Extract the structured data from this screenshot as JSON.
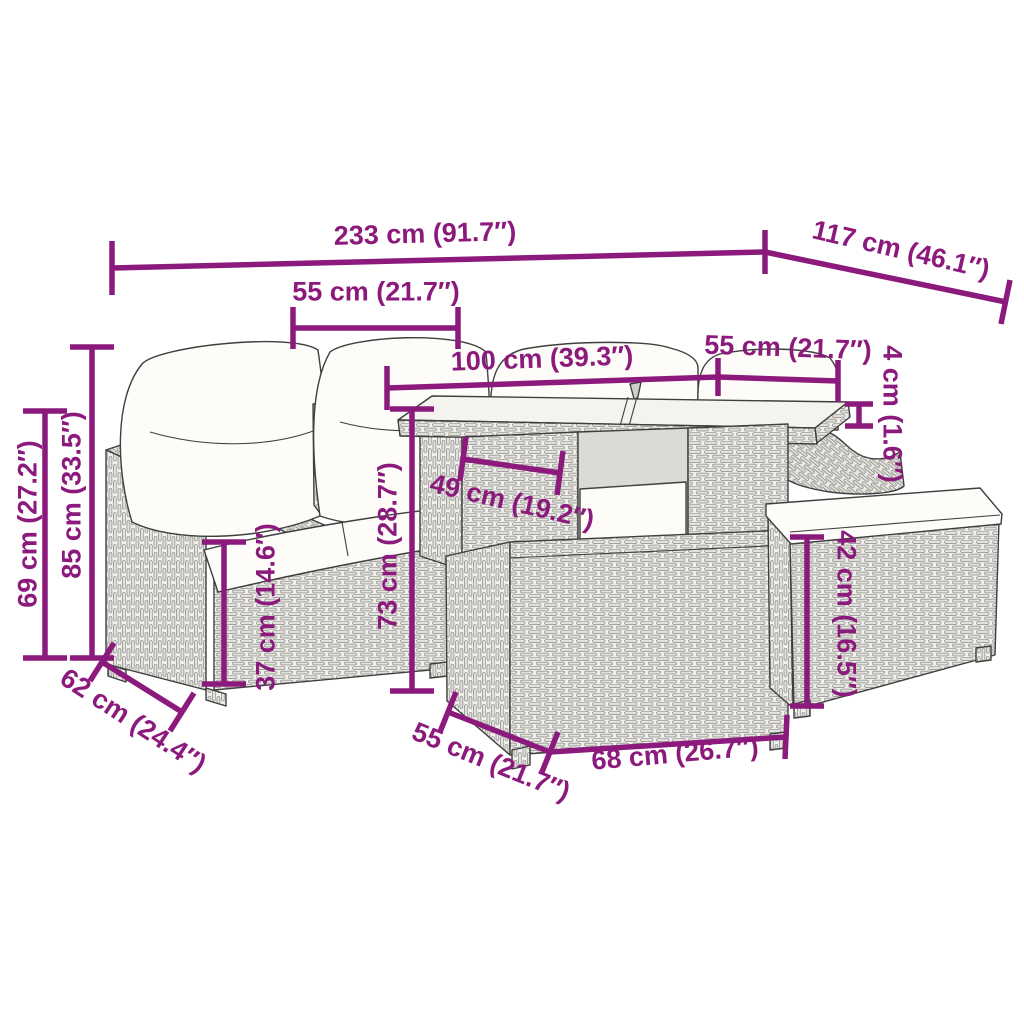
{
  "colors": {
    "accent": "#8C1A7D",
    "outline": "#3F3F3F",
    "wicker": "#E2E1DC",
    "cushion": "#FDFCF8",
    "background": "#FFFFFF"
  },
  "dims": {
    "overall_width": "233 cm (91.7″)",
    "overall_depth": "117 cm (46.1″)",
    "seat_width": "55 cm (21.7″)",
    "table_width": "100 cm (39.3″)",
    "table_depth": "55 cm (21.7″)",
    "glass_thickness": "4 cm (1.6″)",
    "arm_height": "69 cm (27.2″)",
    "back_height": "85 cm (33.5″)",
    "seat_height": "37 cm (14.6″)",
    "table_height": "73 cm (28.7″)",
    "shelf_width": "49 cm (19.2″)",
    "stool_height": "42 cm (16.5″)",
    "sofa_depth": "62 cm (24.4″)",
    "box_depth": "55 cm (21.7″)",
    "box_width": "68 cm (26.7″)"
  }
}
